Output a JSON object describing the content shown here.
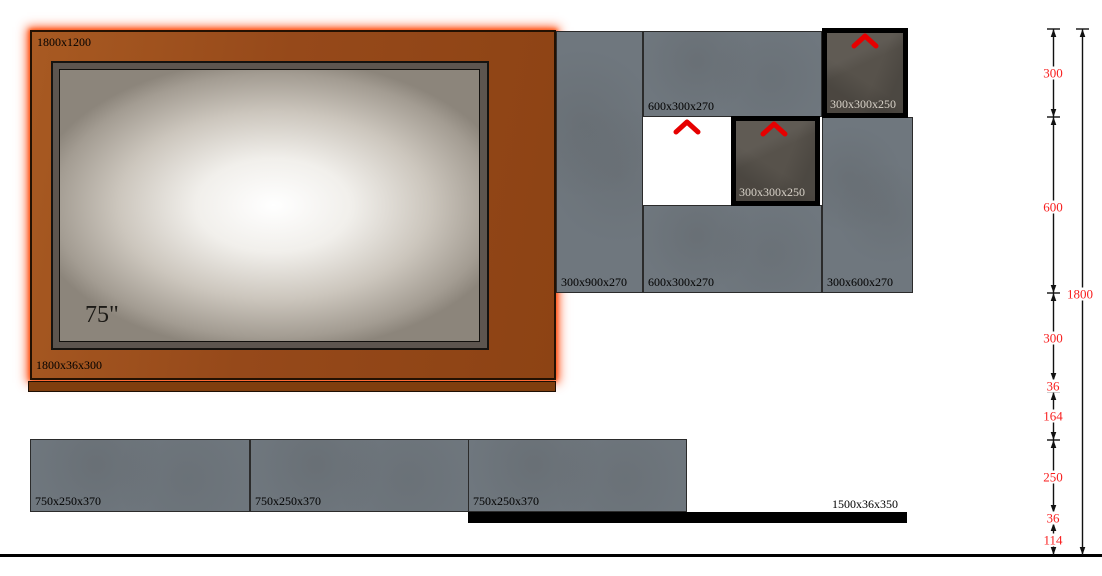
{
  "backdrop": {
    "size_label": "1800x1200",
    "shelf_label": "1800x36x300",
    "tv_label": "75\""
  },
  "unit": {
    "blocks": [
      {
        "label": "300x900x270"
      },
      {
        "label": "600x300x270"
      },
      {
        "label": "600x300x270"
      },
      {
        "label": "300x600x270"
      }
    ],
    "dark_boxes": [
      {
        "label": "300x300x250"
      },
      {
        "label": "300x300x250"
      }
    ]
  },
  "bottom": {
    "shelves": [
      {
        "label": "750x250x370"
      },
      {
        "label": "750x250x370"
      },
      {
        "label": "750x250x370"
      }
    ],
    "bar_label": "1500x36x350"
  },
  "dimensions": {
    "chain": [
      "300",
      "600",
      "300",
      "36",
      "164",
      "250",
      "36",
      "114"
    ],
    "overall": "1800",
    "labels": [
      "300",
      "600",
      "300",
      "36",
      "164",
      "250",
      "36",
      "114",
      "1800"
    ]
  },
  "icons": {
    "vent_arrow": "red-up-chevron"
  },
  "colors": {
    "panel_orange": "#96491a",
    "panel_glow": "#ff3e00",
    "cabinet_gray": "#6f777e",
    "dark_box": "#57524b",
    "dimension_red": "#f81e1e",
    "chevron_red": "#e60000"
  }
}
